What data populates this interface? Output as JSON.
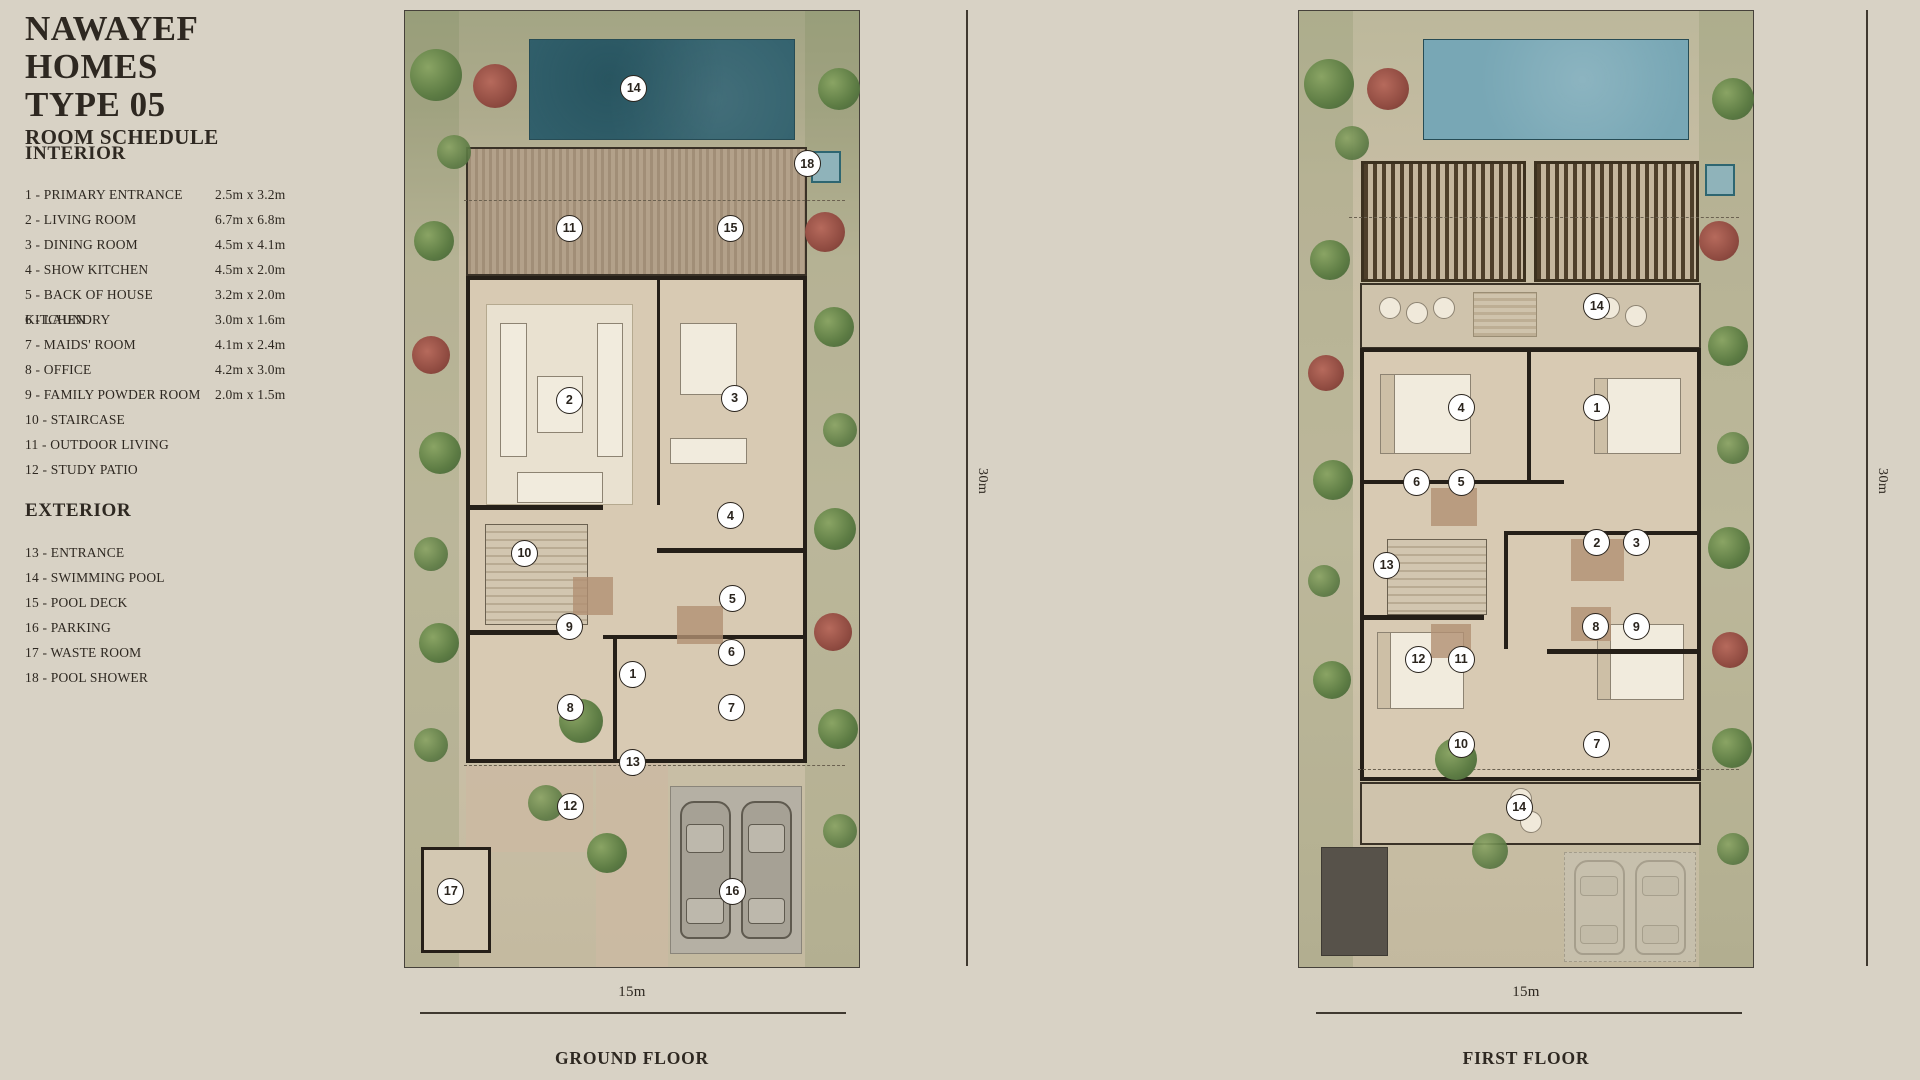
{
  "header": {
    "title_line1": "NAWAYEF HOMES",
    "title_line2": "TYPE 05",
    "subtitle": "ROOM SCHEDULE"
  },
  "legend": {
    "interior_heading": "INTERIOR",
    "interior": [
      {
        "num": "1",
        "name": "PRIMARY ENTRANCE",
        "dims": "2.5m x 3.2m"
      },
      {
        "num": "2",
        "name": "LIVING ROOM",
        "dims": "6.7m x 6.8m"
      },
      {
        "num": "3",
        "name": "DINING ROOM",
        "dims": "4.5m x 4.1m"
      },
      {
        "num": "4",
        "name": "SHOW KITCHEN",
        "dims": "4.5m x 2.0m"
      },
      {
        "num": "5",
        "name": "BACK OF HOUSE KITCHEN",
        "dims": "3.2m x 2.0m"
      },
      {
        "num": "6",
        "name": "LAUNDRY",
        "dims": "3.0m x 1.6m"
      },
      {
        "num": "7",
        "name": "MAIDS' ROOM",
        "dims": "4.1m x 2.4m"
      },
      {
        "num": "8",
        "name": "OFFICE",
        "dims": "4.2m x 3.0m"
      },
      {
        "num": "9",
        "name": "FAMILY POWDER ROOM",
        "dims": "2.0m x 1.5m"
      },
      {
        "num": "10",
        "name": "STAIRCASE",
        "dims": ""
      },
      {
        "num": "11",
        "name": "OUTDOOR LIVING",
        "dims": ""
      },
      {
        "num": "12",
        "name": "STUDY PATIO",
        "dims": ""
      }
    ],
    "exterior_heading": "EXTERIOR",
    "exterior": [
      {
        "num": "13",
        "name": "ENTRANCE",
        "dims": ""
      },
      {
        "num": "14",
        "name": "SWIMMING POOL",
        "dims": ""
      },
      {
        "num": "15",
        "name": "POOL DECK",
        "dims": ""
      },
      {
        "num": "16",
        "name": "PARKING",
        "dims": ""
      },
      {
        "num": "17",
        "name": "WASTE ROOM",
        "dims": ""
      },
      {
        "num": "18",
        "name": "POOL SHOWER",
        "dims": ""
      }
    ]
  },
  "plans": {
    "ground": {
      "caption": "GROUND FLOOR",
      "width_label": "15m",
      "height_label": "30m",
      "markers": [
        {
          "n": "14",
          "x": 50.4,
          "y": 8.1
        },
        {
          "n": "18",
          "x": 88.6,
          "y": 16.0
        },
        {
          "n": "11",
          "x": 36.2,
          "y": 22.7
        },
        {
          "n": "15",
          "x": 71.7,
          "y": 22.7
        },
        {
          "n": "2",
          "x": 36.2,
          "y": 40.7
        },
        {
          "n": "3",
          "x": 72.6,
          "y": 40.5
        },
        {
          "n": "4",
          "x": 71.7,
          "y": 52.8
        },
        {
          "n": "10",
          "x": 26.3,
          "y": 56.7
        },
        {
          "n": "5",
          "x": 72.1,
          "y": 61.5
        },
        {
          "n": "9",
          "x": 36.2,
          "y": 64.4
        },
        {
          "n": "6",
          "x": 71.9,
          "y": 67.1
        },
        {
          "n": "1",
          "x": 50.2,
          "y": 69.4
        },
        {
          "n": "8",
          "x": 36.4,
          "y": 72.9
        },
        {
          "n": "7",
          "x": 71.9,
          "y": 72.9
        },
        {
          "n": "13",
          "x": 50.2,
          "y": 78.6
        },
        {
          "n": "12",
          "x": 36.4,
          "y": 83.2
        },
        {
          "n": "17",
          "x": 10.1,
          "y": 92.1
        },
        {
          "n": "16",
          "x": 72.1,
          "y": 92.1
        }
      ]
    },
    "first": {
      "caption": "FIRST FLOOR",
      "width_label": "15m",
      "height_label": "30m",
      "markers": [
        {
          "n": "14",
          "x": 65.6,
          "y": 30.9
        },
        {
          "n": "4",
          "x": 35.7,
          "y": 41.5
        },
        {
          "n": "1",
          "x": 65.6,
          "y": 41.5
        },
        {
          "n": "6",
          "x": 25.9,
          "y": 49.3
        },
        {
          "n": "5",
          "x": 35.7,
          "y": 49.3
        },
        {
          "n": "2",
          "x": 65.6,
          "y": 55.6
        },
        {
          "n": "3",
          "x": 74.3,
          "y": 55.6
        },
        {
          "n": "13",
          "x": 19.3,
          "y": 58.0
        },
        {
          "n": "8",
          "x": 65.4,
          "y": 64.4
        },
        {
          "n": "9",
          "x": 74.3,
          "y": 64.4
        },
        {
          "n": "12",
          "x": 26.3,
          "y": 67.8
        },
        {
          "n": "11",
          "x": 35.7,
          "y": 67.8
        },
        {
          "n": "10",
          "x": 35.7,
          "y": 76.7
        },
        {
          "n": "7",
          "x": 65.6,
          "y": 76.7
        },
        {
          "n": "14",
          "x": 48.5,
          "y": 83.3
        }
      ]
    }
  },
  "colors": {
    "background": "#d8d2c5",
    "ink": "#2e2821",
    "wall": "#251f18",
    "pool_ground": "#33626e",
    "pool_first": "#78a7b5",
    "deck": "#ad9b85",
    "marker_bg": "#ffffff"
  }
}
